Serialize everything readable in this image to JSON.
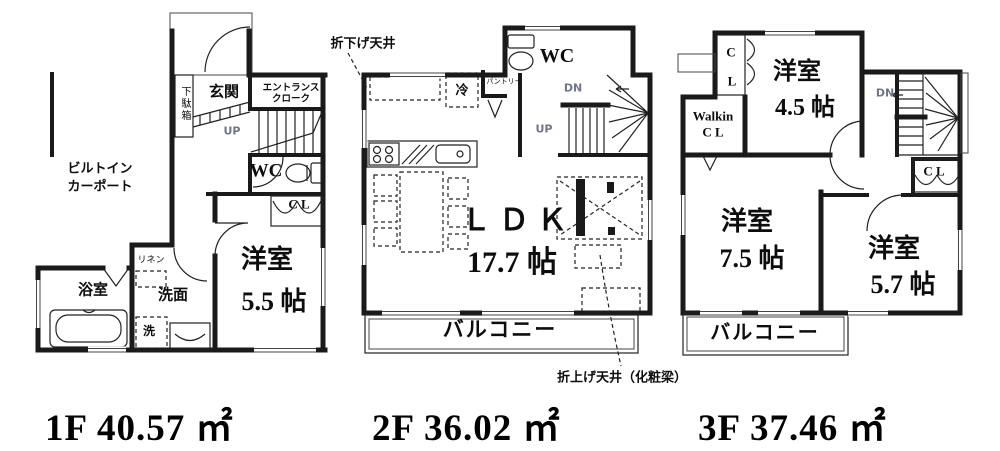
{
  "colors": {
    "wall": "#1a1a1a",
    "text": "#000000",
    "stair_text": "#6e7687",
    "background": "#ffffff"
  },
  "floors": {
    "f1": {
      "area_label": "1F 40.57 ㎡",
      "labels": {
        "carport_line1": "ビルトイン",
        "carport_line2": "カーポート",
        "genkan": "玄関",
        "getabako": "下駄箱",
        "cloak_line1": "エントランス",
        "cloak_line2": "クローク",
        "up": "UP",
        "wc": "WC",
        "closet": "C L",
        "room_name": "洋室",
        "room_size": "5.5 帖",
        "bath": "浴室",
        "linen": "リネン",
        "washroom": "洗面",
        "laundry": "洗"
      }
    },
    "f2": {
      "area_label": "2F 36.02 ㎡",
      "labels": {
        "ceiling_drop": "折下げ天井",
        "wc": "WC",
        "fridge": "冷",
        "pantry": "パントリー",
        "dn": "DN",
        "up": "UP",
        "ldk_name": "ＬＤＫ",
        "ldk_size": "17.7 帖",
        "balcony": "バルコニー",
        "ceiling_raise": "折上げ天井（化粧梁）"
      }
    },
    "f3": {
      "area_label": "3F 37.46 ㎡",
      "labels": {
        "closet_c": "C",
        "closet_l": "L",
        "room1_name": "洋室",
        "room1_size": "4.5 帖",
        "walkin_line1": "Walkin",
        "walkin_line2": "C L",
        "dn": "DN",
        "closet": "C L",
        "room2_name": "洋室",
        "room2_size": "7.5 帖",
        "room3_name": "洋室",
        "room3_size": "5.7 帖",
        "balcony": "バルコニー"
      }
    }
  }
}
